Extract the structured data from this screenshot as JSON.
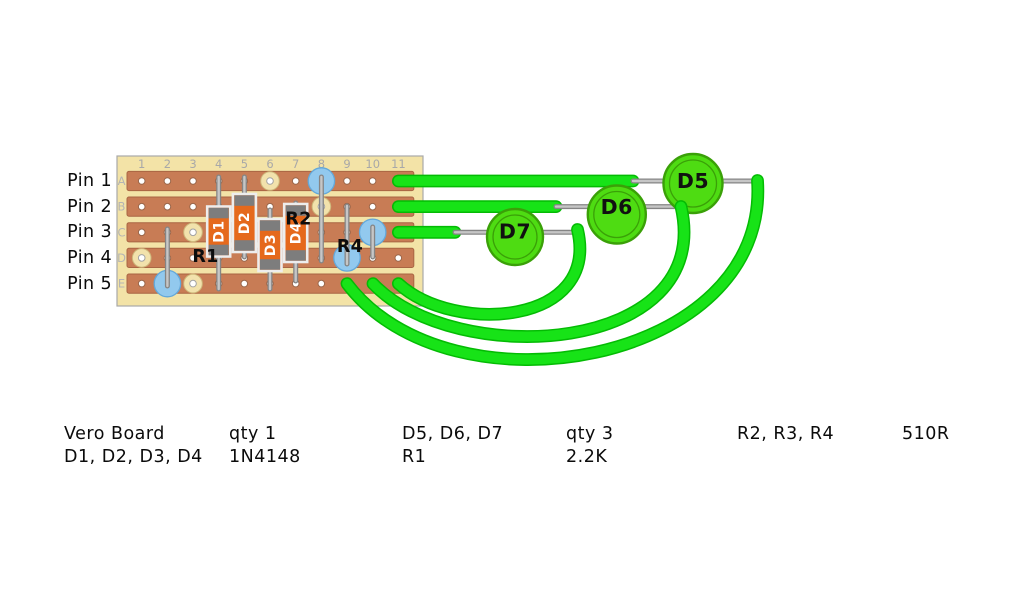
{
  "pins": {
    "labels": [
      "Pin 1",
      "Pin 2",
      "Pin 3",
      "Pin 4",
      "Pin 5"
    ]
  },
  "board": {
    "columns": [
      "1",
      "2",
      "3",
      "4",
      "5",
      "6",
      "7",
      "8",
      "9",
      "10",
      "11"
    ],
    "rows": [
      "A",
      "B",
      "C",
      "D",
      "E"
    ]
  },
  "components": {
    "diodes": [
      "D1",
      "D2",
      "D3",
      "D4"
    ],
    "resistor_labels": [
      "R1",
      "R2",
      "R4"
    ],
    "leds": [
      "D5",
      "D6",
      "D7"
    ]
  },
  "bom": [
    [
      "Vero Board",
      "D1, D2, D3, D4"
    ],
    [
      "qty 1",
      "1N4148"
    ],
    [
      "D5, D6, D7",
      "R1"
    ],
    [
      "qty 3",
      "2.2K"
    ],
    [
      "R2, R3, R4"
    ],
    [
      "510R"
    ]
  ],
  "colors": {
    "wire_green": "#17e317",
    "led_green": "#4edc12",
    "strip_copper": "#c87c55",
    "board_tan": "#f3e3a7",
    "solder_blue": "#92c9ee",
    "diode_orange": "#e5691c"
  }
}
